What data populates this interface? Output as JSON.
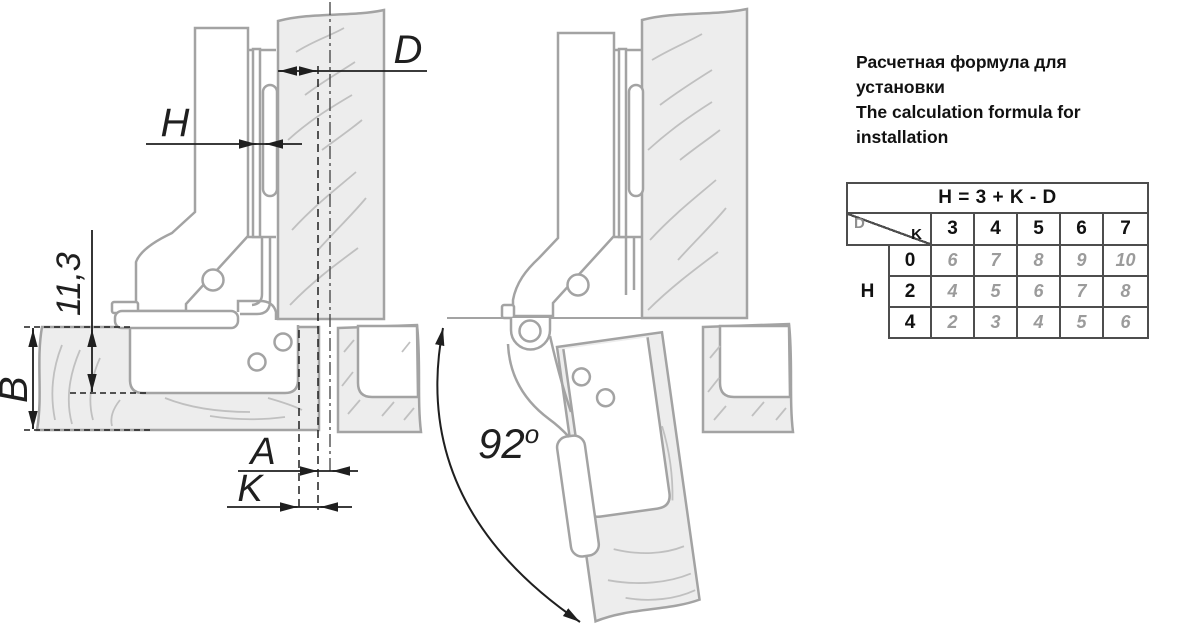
{
  "colors": {
    "panel_fill": "#ededed",
    "outline_gray": "#a3a3a3",
    "grain_gray": "#c0c0c0",
    "dimension_black": "#1f1f1f",
    "table_border": "#4d4d4d",
    "value_gray": "#9b9b9b"
  },
  "diagram_closed": {
    "dim_overlay": "D",
    "dim_plate": "H",
    "dim_depth": "11,3",
    "dim_thickness": "B",
    "dim_a": "A",
    "dim_k": "K"
  },
  "diagram_open": {
    "angle": "92",
    "angle_sup": "o"
  },
  "panel": {
    "title_lines": [
      "Расчетная формула для",
      "установки",
      "The calculation formula for",
      "installation"
    ],
    "table": {
      "formula": "H = 3 + K - D",
      "diag_row": "D",
      "diag_col": "K",
      "col_headers": [
        "3",
        "4",
        "5",
        "6",
        "7"
      ],
      "row_label": "H",
      "rows": [
        {
          "key": "0",
          "values": [
            "6",
            "7",
            "8",
            "9",
            "10"
          ]
        },
        {
          "key": "2",
          "values": [
            "4",
            "5",
            "6",
            "7",
            "8"
          ]
        },
        {
          "key": "4",
          "values": [
            "2",
            "3",
            "4",
            "5",
            "6"
          ]
        }
      ]
    }
  }
}
